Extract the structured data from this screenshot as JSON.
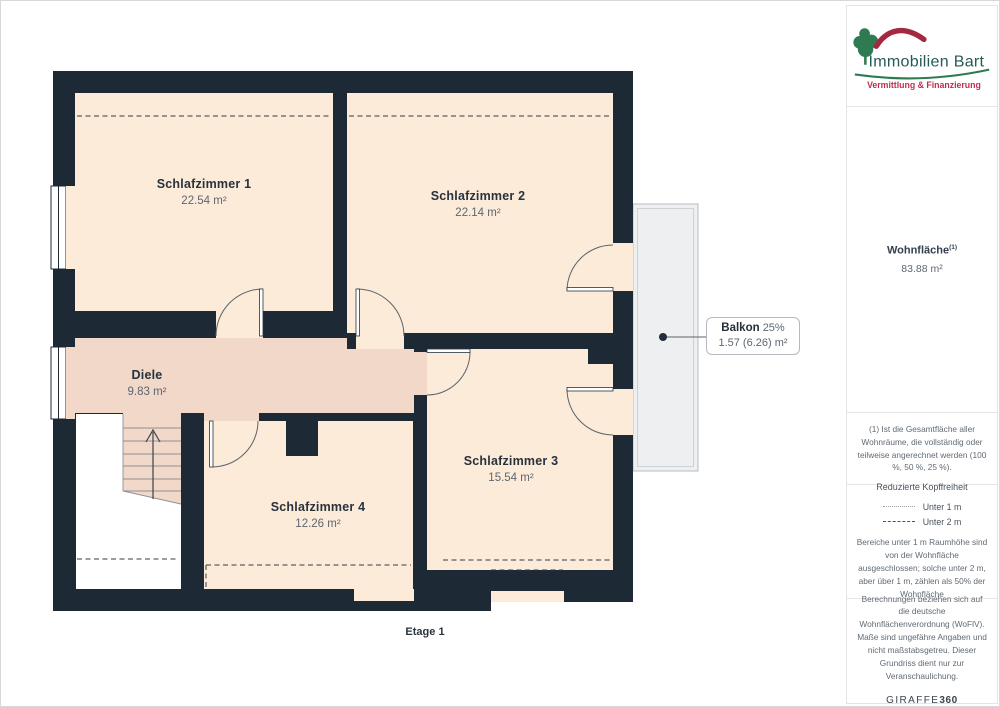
{
  "logo": {
    "name": "Immobilien Bart",
    "tagline": "Vermittlung & Finanzierung"
  },
  "sidebar": {
    "area_title": "Wohnfläche",
    "area_title_sup": "(1)",
    "area_value": "83.88 m²",
    "note1": "(1) Ist die Gesamtfläche aller Wohnräume, die vollständig oder teilweise angerechnet werden (100 %, 50 %, 25 %).",
    "legend": {
      "title": "Reduzierte Kopffreiheit",
      "items": [
        {
          "style": "dotted",
          "label": "Unter 1 m"
        },
        {
          "style": "dashed",
          "label": "Unter 2 m"
        }
      ],
      "note": "Bereiche unter 1 m Raumhöhe sind von der Wohnfläche ausgeschlossen; solche unter 2 m, aber über 1 m, zählen als 50% der Wohnfläche"
    },
    "footer": {
      "note": "Berechnungen beziehen sich auf die deutsche Wohnflächenverordnung (WoFlV). Maße sind ungefähre Angaben und nicht maßstabsgetreu. Dieser Grundriss dient nur zur Veranschaulichung.",
      "brand_light": "GIRAFFE",
      "brand_bold": "360"
    }
  },
  "floorplan": {
    "floor_label": "Etage 1",
    "rooms": [
      {
        "name": "Schlafzimmer 1",
        "area": "22.54 m²"
      },
      {
        "name": "Schlafzimmer 2",
        "area": "22.14 m²"
      },
      {
        "name": "Schlafzimmer 3",
        "area": "15.54 m²"
      },
      {
        "name": "Schlafzimmer 4",
        "area": "12.26 m²"
      },
      {
        "name": "Diele",
        "area": "9.83 m²"
      }
    ],
    "balcony": {
      "name": "Balkon",
      "percent": "25%",
      "area": "1.57 (6.26) m²"
    }
  },
  "colors": {
    "wall": "#1d2935",
    "room_fill": "#fcebd9",
    "hall_fill": "#f1d8c9",
    "balcony_fill": "#edeff1",
    "logo_green": "#2e7b52",
    "logo_red": "#a32840",
    "tagline_red": "#c02c4e",
    "text_dark": "#28323d",
    "text_gray": "#5d6771"
  }
}
